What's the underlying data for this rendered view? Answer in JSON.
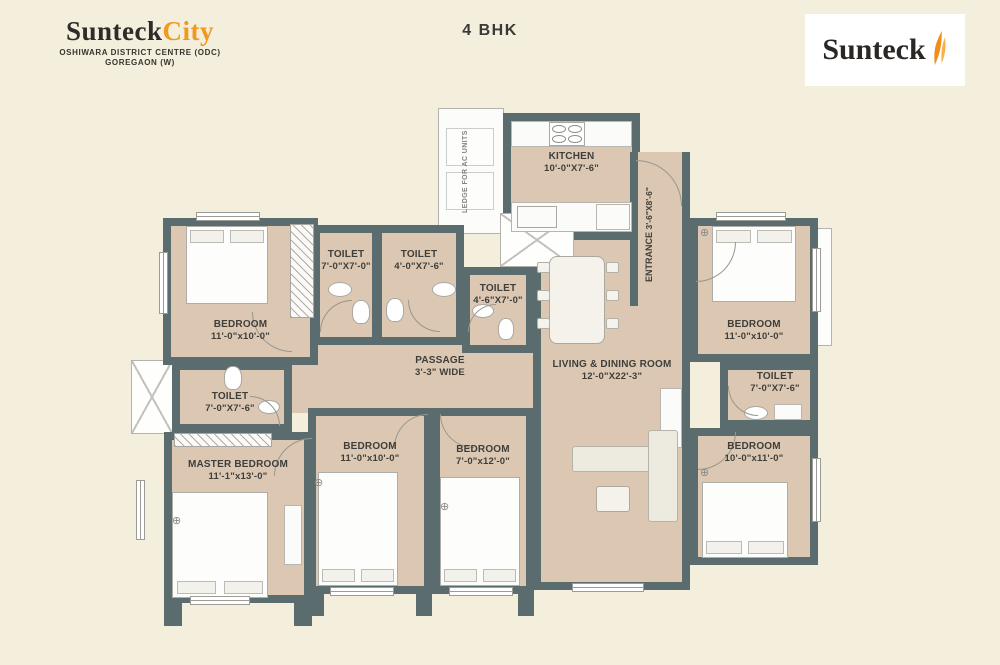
{
  "header": {
    "brand_primary": "Sunteck",
    "brand_secondary": "City",
    "brand_subtitle1": "OSHIWARA DISTRICT CENTRE (ODC)",
    "brand_subtitle2": "GOREGAON (W)",
    "plan_title": "4 BHK",
    "logo_text": "Sunteck"
  },
  "rooms": {
    "kitchen": {
      "name": "KITCHEN",
      "dims": "10'-0\"X7'-6\""
    },
    "ledge_ac": {
      "name": "LEDGE FOR AC UNITS"
    },
    "entrance": {
      "name": "ENTRANCE",
      "dims": "3'-6\"X8'-6\""
    },
    "toilet_top_left": {
      "name": "TOILET",
      "dims": "7'-0\"X7'-0\""
    },
    "toilet_top_mid": {
      "name": "TOILET",
      "dims": "4'-0\"X7'-6\""
    },
    "toilet_mid": {
      "name": "TOILET",
      "dims": "4'-6\"X7'-0\""
    },
    "bedroom_top_left": {
      "name": "BEDROOM",
      "dims": "11'-0\"x10'-0\""
    },
    "toilet_left": {
      "name": "TOILET",
      "dims": "7'-0\"X7'-6\""
    },
    "master_bedroom": {
      "name": "MASTER BEDROOM",
      "dims": "11'-1\"x13'-0\""
    },
    "bedroom_mid_left": {
      "name": "BEDROOM",
      "dims": "11'-0\"x10'-0\""
    },
    "bedroom_mid_right": {
      "name": "BEDROOM",
      "dims": "7'-0\"x12'-0\""
    },
    "passage": {
      "name": "PASSAGE",
      "dims": "3'-3\" WIDE"
    },
    "living_dining": {
      "name": "LIVING & DINING ROOM",
      "dims": "12'-0\"X22'-3\""
    },
    "bedroom_top_right": {
      "name": "BEDROOM",
      "dims": "11'-0\"x10'-0\""
    },
    "toilet_right": {
      "name": "TOILET",
      "dims": "7'-0\"X7'-6\""
    },
    "bedroom_bottom_right": {
      "name": "BEDROOM",
      "dims": "10'-0\"x11'-0\""
    }
  },
  "colors": {
    "bg": "#f4eedd",
    "wall": "#5a6c6e",
    "floor": "#dcc8b2",
    "orange": "#f0991d",
    "text": "#3c3c3a"
  }
}
